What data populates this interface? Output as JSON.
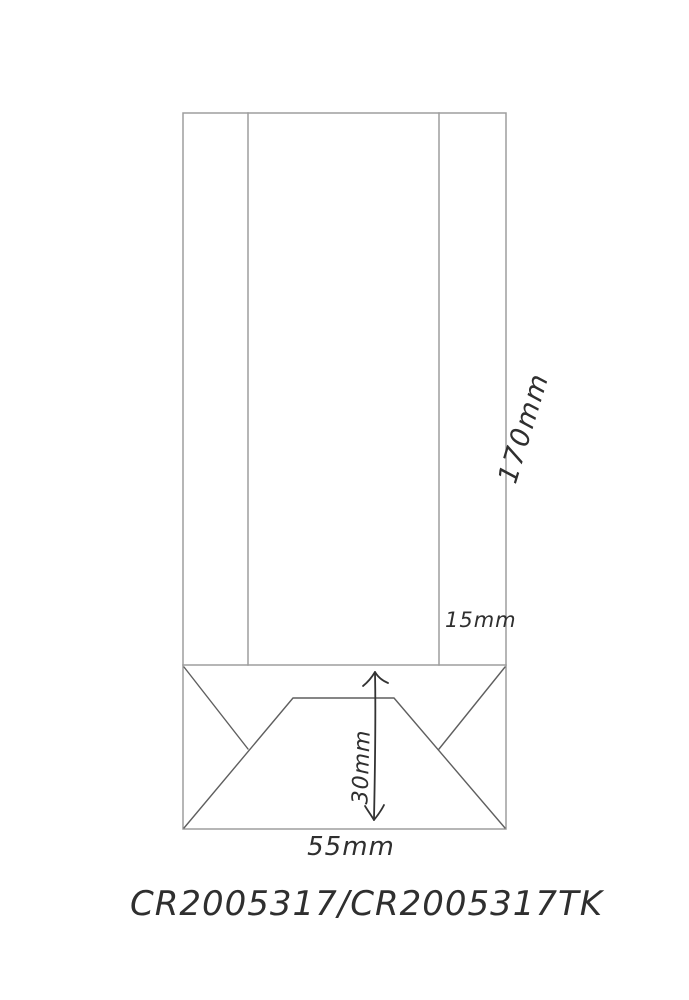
{
  "drawing": {
    "type": "packaging-bag-dimension-sketch",
    "labels": {
      "height": "170mm",
      "side_gusset": "15mm",
      "bottom_height": "30mm",
      "bottom_width": "55mm"
    },
    "product_code": "CR2005317/CR2005317TK"
  },
  "colors": {
    "background": "#ffffff",
    "ruled_line": "#9d9d9d",
    "fold_line": "#5f5f5f",
    "pen": "#333333"
  }
}
